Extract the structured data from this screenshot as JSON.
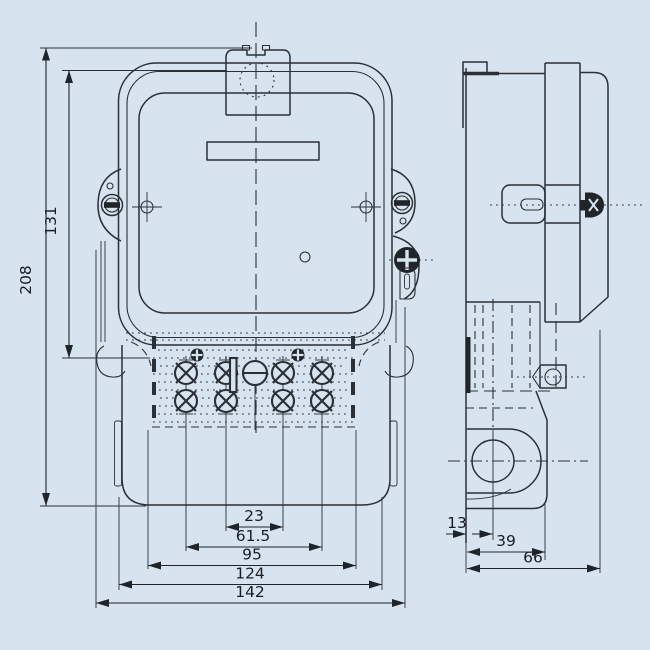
{
  "drawing": {
    "background_color": "#d7e3ee",
    "line_color": "#2b3036",
    "front_view": {
      "dimensions": {
        "overall_height": "208",
        "body_height": "131",
        "inner_terminal_spacing": "23",
        "outer_terminal_spacing": "61.5",
        "terminal_block_width": "95",
        "case_width": "124",
        "overall_width": "142"
      }
    },
    "side_view": {
      "dimensions": {
        "hole_center_offset": "13",
        "terminal_cover_depth": "39",
        "overall_depth": "66"
      }
    }
  }
}
